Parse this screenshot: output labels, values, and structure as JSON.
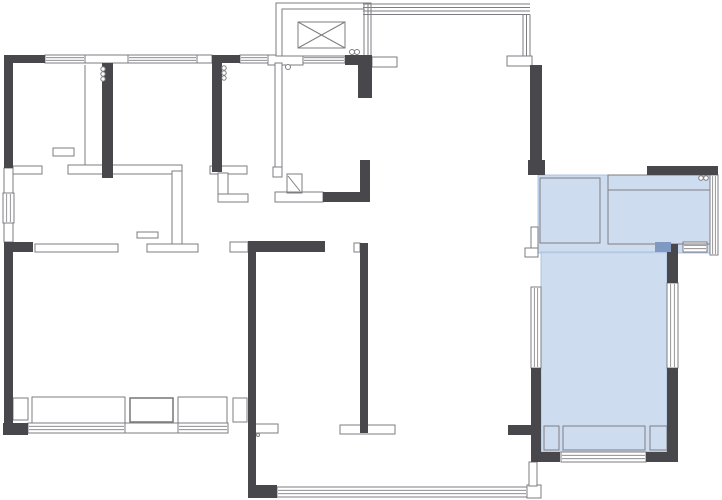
{
  "canvas": {
    "width": 722,
    "height": 500,
    "background": "#ffffff"
  },
  "colors": {
    "wall_dark": "#48484c",
    "line": "#7e7e82",
    "line_light": "#a5a5a8",
    "highlight_fill": "#c5d6ed",
    "highlight_edge": "#9fb8da",
    "accent_fill": "#8099c2",
    "floor": "#ffffff"
  },
  "elements": {
    "highlights": [
      {
        "name": "highlight-room-upper",
        "x": 538,
        "y": 175,
        "w": 172,
        "h": 78
      },
      {
        "name": "highlight-room-lower",
        "x": 541,
        "y": 252,
        "w": 126,
        "h": 200
      }
    ],
    "windows_h": [
      {
        "x": 45,
        "y": 55,
        "w": 40,
        "h": 8
      },
      {
        "x": 128,
        "y": 55,
        "w": 69,
        "h": 8
      },
      {
        "x": 240,
        "y": 55,
        "w": 28,
        "h": 8
      },
      {
        "x": 303,
        "y": 55,
        "w": 42,
        "h": 8
      },
      {
        "x": 28,
        "y": 423,
        "w": 97,
        "h": 10
      },
      {
        "x": 178,
        "y": 423,
        "w": 50,
        "h": 10
      },
      {
        "x": 277,
        "y": 487,
        "w": 250,
        "h": 10
      },
      {
        "x": 561,
        "y": 452,
        "w": 85,
        "h": 10
      },
      {
        "x": 683,
        "y": 242,
        "w": 24,
        "h": 10
      }
    ],
    "windows_v": [
      {
        "x": 3,
        "y": 193,
        "w": 11,
        "h": 30
      },
      {
        "x": 531,
        "y": 287,
        "w": 10,
        "h": 81
      },
      {
        "x": 667,
        "y": 283,
        "w": 11,
        "h": 85
      },
      {
        "x": 710,
        "y": 175,
        "w": 8,
        "h": 80
      }
    ],
    "thin_walls": [
      {
        "x": 85,
        "y": 55,
        "w": 43,
        "h": 8
      },
      {
        "x": 197,
        "y": 55,
        "w": 15,
        "h": 8
      },
      {
        "x": 268,
        "y": 55,
        "w": 35,
        "h": 10
      },
      {
        "x": 372,
        "y": 57,
        "w": 25,
        "h": 10
      },
      {
        "x": 507,
        "y": 56,
        "w": 25,
        "h": 10
      },
      {
        "x": 4,
        "y": 168,
        "w": 9,
        "h": 25
      },
      {
        "x": 4,
        "y": 223,
        "w": 9,
        "h": 19
      },
      {
        "x": 13,
        "y": 166,
        "w": 29,
        "h": 8
      },
      {
        "x": 68,
        "y": 165,
        "w": 114,
        "h": 9
      },
      {
        "x": 172,
        "y": 171,
        "w": 10,
        "h": 77
      },
      {
        "x": 147,
        "y": 244,
        "w": 51,
        "h": 8
      },
      {
        "x": 35,
        "y": 244,
        "w": 83,
        "h": 8
      },
      {
        "x": 230,
        "y": 242,
        "w": 18,
        "h": 10
      },
      {
        "x": 275,
        "y": 63,
        "w": 7,
        "h": 107
      },
      {
        "x": 273,
        "y": 167,
        "w": 9,
        "h": 10
      },
      {
        "x": 275,
        "y": 192,
        "w": 48,
        "h": 10
      },
      {
        "x": 210,
        "y": 166,
        "w": 37,
        "h": 8
      },
      {
        "x": 218,
        "y": 173,
        "w": 10,
        "h": 25
      },
      {
        "x": 218,
        "y": 194,
        "w": 30,
        "h": 8
      },
      {
        "x": 255,
        "y": 424,
        "w": 23,
        "h": 9
      },
      {
        "x": 340,
        "y": 425,
        "w": 55,
        "h": 9
      },
      {
        "x": 527,
        "y": 485,
        "w": 14,
        "h": 13
      },
      {
        "x": 531,
        "y": 227,
        "w": 7,
        "h": 30
      },
      {
        "x": 525,
        "y": 248,
        "w": 13,
        "h": 9
      },
      {
        "x": 529,
        "y": 462,
        "w": 8,
        "h": 24
      },
      {
        "x": 354,
        "y": 243,
        "w": 6,
        "h": 9
      }
    ],
    "elevator": {
      "outer": {
        "x": 276,
        "y": 3,
        "w": 95,
        "h": 53
      },
      "inner": {
        "x": 282,
        "y": 9,
        "w": 82,
        "h": 47
      },
      "car": {
        "x": 298,
        "y": 22,
        "w": 47,
        "h": 26
      }
    },
    "boxes": [
      {
        "x": 13,
        "y": 398,
        "w": 15,
        "h": 22
      },
      {
        "x": 32,
        "y": 397,
        "w": 93,
        "h": 26
      },
      {
        "x": 130,
        "y": 398,
        "w": 43,
        "h": 24,
        "sw": 1.6
      },
      {
        "x": 178,
        "y": 397,
        "w": 49,
        "h": 26
      },
      {
        "x": 233,
        "y": 398,
        "w": 14,
        "h": 24
      },
      {
        "x": 125,
        "y": 423,
        "w": 53,
        "h": 10
      },
      {
        "x": 544,
        "y": 426,
        "w": 15,
        "h": 24
      },
      {
        "x": 563,
        "y": 426,
        "w": 82,
        "h": 24
      },
      {
        "x": 650,
        "y": 426,
        "w": 17,
        "h": 24
      },
      {
        "x": 53,
        "y": 148,
        "w": 21,
        "h": 8
      },
      {
        "x": 137,
        "y": 232,
        "w": 21,
        "h": 6
      },
      {
        "x": 540,
        "y": 178,
        "w": 60,
        "h": 65
      },
      {
        "x": 608,
        "y": 175,
        "w": 102,
        "h": 69
      },
      {
        "x": 287,
        "y": 174,
        "w": 15,
        "h": 19
      }
    ],
    "lines": [
      {
        "x1": 85,
        "y1": 65,
        "x2": 85,
        "y2": 165
      },
      {
        "x1": 608,
        "y1": 190,
        "x2": 710,
        "y2": 190
      },
      {
        "x1": 363,
        "y1": 4,
        "x2": 530,
        "y2": 4
      },
      {
        "x1": 363,
        "y1": 7.5,
        "x2": 530,
        "y2": 7.5
      },
      {
        "x1": 363,
        "y1": 11,
        "x2": 530,
        "y2": 11
      },
      {
        "x1": 363,
        "y1": 14.5,
        "x2": 530,
        "y2": 14.5
      },
      {
        "x1": 523,
        "y1": 14.5,
        "x2": 523,
        "y2": 56
      },
      {
        "x1": 526.5,
        "y1": 14.5,
        "x2": 526.5,
        "y2": 56
      },
      {
        "x1": 530,
        "y1": 14.5,
        "x2": 530,
        "y2": 56
      },
      {
        "x1": 364,
        "y1": 4,
        "x2": 364,
        "y2": 55
      },
      {
        "x1": 368,
        "y1": 4,
        "x2": 368,
        "y2": 55
      },
      {
        "x1": 288,
        "y1": 176,
        "x2": 300,
        "y2": 191
      }
    ],
    "dark_walls": [
      {
        "x": 4,
        "y": 55,
        "w": 41,
        "h": 8
      },
      {
        "x": 212,
        "y": 55,
        "w": 28,
        "h": 8
      },
      {
        "x": 345,
        "y": 55,
        "w": 27,
        "h": 10
      },
      {
        "x": 358,
        "y": 55,
        "w": 14,
        "h": 43
      },
      {
        "x": 4,
        "y": 55,
        "w": 9,
        "h": 113
      },
      {
        "x": 102,
        "y": 63,
        "w": 11,
        "h": 115
      },
      {
        "x": 212,
        "y": 63,
        "w": 10,
        "h": 109
      },
      {
        "x": 360,
        "y": 160,
        "w": 10,
        "h": 33
      },
      {
        "x": 323,
        "y": 192,
        "w": 47,
        "h": 10
      },
      {
        "x": 4,
        "y": 242,
        "w": 9,
        "h": 193
      },
      {
        "x": 4,
        "y": 242,
        "w": 29,
        "h": 10
      },
      {
        "x": 3,
        "y": 423,
        "w": 25,
        "h": 12
      },
      {
        "x": 248,
        "y": 241,
        "w": 77,
        "h": 11
      },
      {
        "x": 248,
        "y": 252,
        "w": 8,
        "h": 246
      },
      {
        "x": 248,
        "y": 485,
        "w": 29,
        "h": 13
      },
      {
        "x": 360,
        "y": 243,
        "w": 8,
        "h": 190
      },
      {
        "x": 508,
        "y": 425,
        "w": 25,
        "h": 10
      },
      {
        "x": 530,
        "y": 65,
        "w": 12,
        "h": 95
      },
      {
        "x": 528,
        "y": 160,
        "w": 17,
        "h": 15
      },
      {
        "x": 647,
        "y": 166,
        "w": 71,
        "h": 9
      },
      {
        "x": 667,
        "y": 244,
        "w": 11,
        "h": 39
      },
      {
        "x": 667,
        "y": 368,
        "w": 11,
        "h": 94
      },
      {
        "x": 531,
        "y": 368,
        "w": 10,
        "h": 94
      },
      {
        "x": 533,
        "y": 452,
        "w": 27,
        "h": 10
      },
      {
        "x": 646,
        "y": 452,
        "w": 32,
        "h": 10
      }
    ],
    "accents": [
      {
        "x": 655,
        "y": 242,
        "w": 16,
        "h": 10
      }
    ],
    "circles": [
      {
        "cx": 103,
        "cy": 69,
        "r": 2.2
      },
      {
        "cx": 103,
        "cy": 74,
        "r": 2.2
      },
      {
        "cx": 103,
        "cy": 79,
        "r": 2.2
      },
      {
        "cx": 224,
        "cy": 68,
        "r": 2.2
      },
      {
        "cx": 224,
        "cy": 73,
        "r": 2.2
      },
      {
        "cx": 224,
        "cy": 78,
        "r": 2.2
      },
      {
        "cx": 288,
        "cy": 67,
        "r": 2.5
      },
      {
        "cx": 352,
        "cy": 52,
        "r": 2.5
      },
      {
        "cx": 357,
        "cy": 52,
        "r": 2.5
      },
      {
        "cx": 701,
        "cy": 178,
        "r": 2.3
      },
      {
        "cx": 706,
        "cy": 178,
        "r": 2.3
      },
      {
        "cx": 258,
        "cy": 435,
        "r": 1.5
      }
    ]
  }
}
